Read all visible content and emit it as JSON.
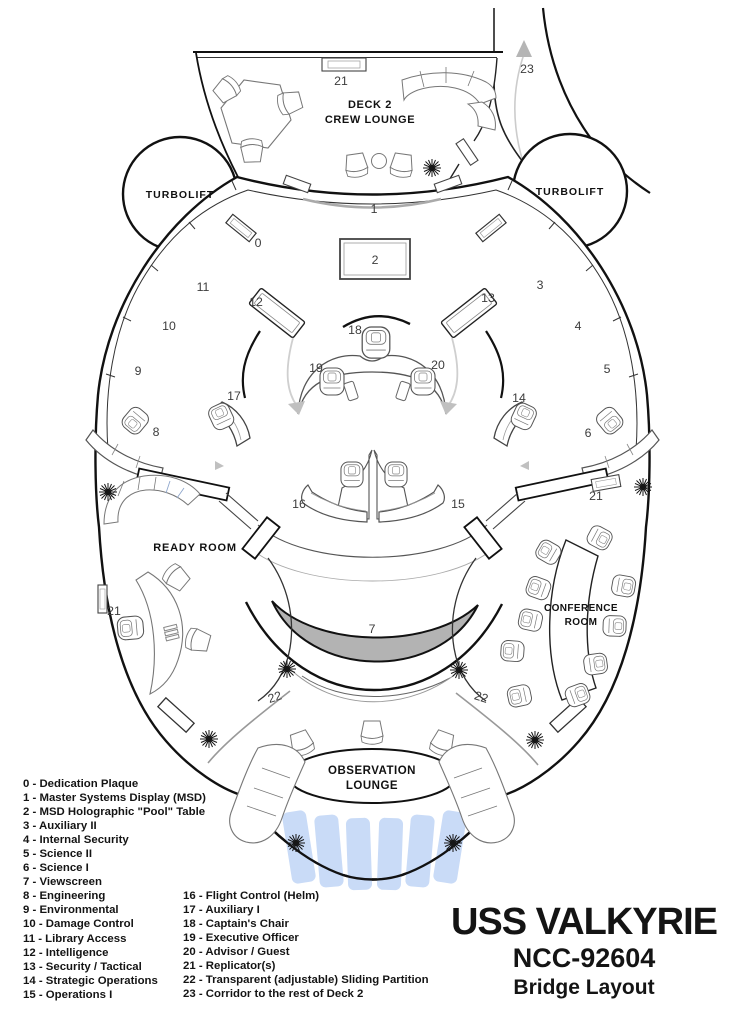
{
  "colors": {
    "line": "#141414",
    "furniture_line": "#555555",
    "light_line": "#bbbbbb",
    "viewscreen_fill": "#b3b3b3",
    "window_fill": "#c9dbf7",
    "background": "#ffffff"
  },
  "title_block": {
    "ship_name": "USS VALKYRIE",
    "registry": "NCC-92604",
    "subtitle": "Bridge Layout"
  },
  "room_labels": {
    "deck2_line1": "DECK 2",
    "deck2_line2": "CREW LOUNGE",
    "turbolift_left": "TURBOLIFT",
    "turbolift_right": "TURBOLIFT",
    "ready_room": "READY ROOM",
    "conference_line1": "CONFERENCE",
    "conference_line2": "ROOM",
    "observation_line1": "OBSERVATION",
    "observation_line2": "LOUNGE"
  },
  "callouts": {
    "c0": "0",
    "c1": "1",
    "c2": "2",
    "c3": "3",
    "c4": "4",
    "c5": "5",
    "c6": "6",
    "c7": "7",
    "c8": "8",
    "c9": "9",
    "c10": "10",
    "c11": "11",
    "c12": "12",
    "c13": "13",
    "c14": "14",
    "c15": "15",
    "c16": "16",
    "c17": "17",
    "c18": "18",
    "c19": "19",
    "c20": "20",
    "c21_lounge": "21",
    "c21_ready": "21",
    "c21_conf": "21",
    "c22_left": "22",
    "c22_right": "22",
    "c23": "23"
  },
  "legend": {
    "column1": [
      "0 - Dedication Plaque",
      "1 - Master Systems Display (MSD)",
      "2 - MSD Holographic \"Pool\" Table",
      "3 - Auxiliary II",
      "4 - Internal Security",
      "5 - Science II",
      "6 - Science I",
      "7 - Viewscreen",
      "8 - Engineering",
      "9 - Environmental",
      "10 - Damage Control",
      "11 - Library Access",
      "12 - Intelligence",
      "13 - Security / Tactical",
      "14 - Strategic Operations",
      "15 - Operations I"
    ],
    "column2": [
      "16 - Flight Control (Helm)",
      "17 - Auxiliary I",
      "18 - Captain's Chair",
      "19 - Executive Officer",
      "20 - Advisor / Guest",
      "21 - Replicator(s)",
      "22 - Transparent (adjustable) Sliding Partition",
      "23 - Corridor to the rest of Deck 2"
    ]
  }
}
